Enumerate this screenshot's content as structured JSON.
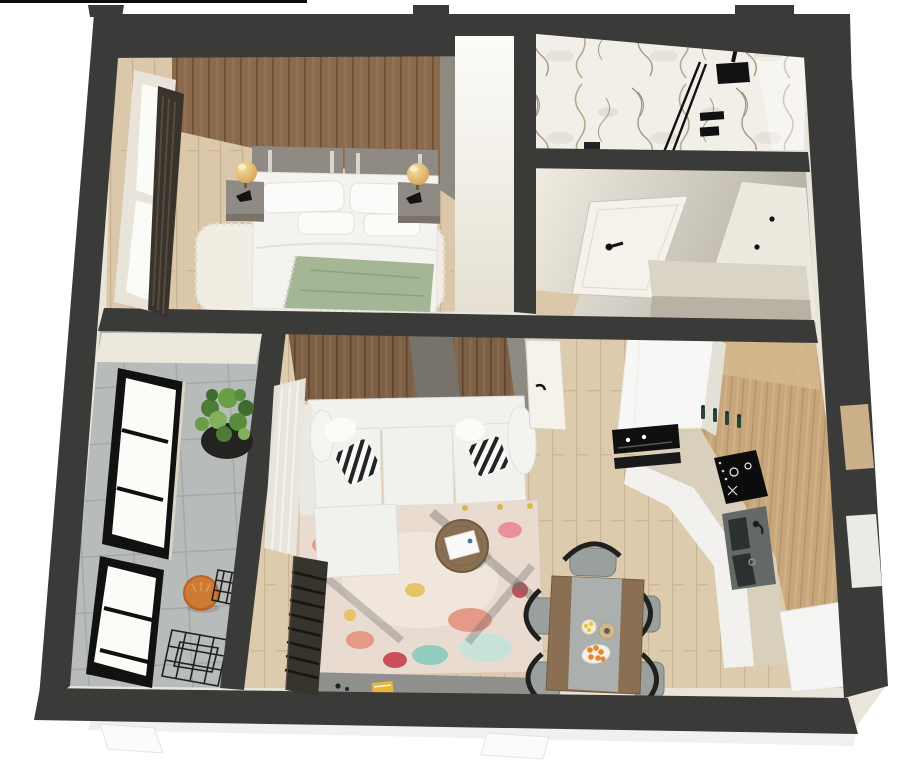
{
  "meta": {
    "type": "3d-floorplan-render",
    "style": "isometric cutaway, top-down perspective",
    "background": "#ffffff"
  },
  "palette": {
    "wall": "#3a3a38",
    "creamBase": "#e9e5da",
    "slab": "#f0f1ef",
    "floorWood": "#dbc8ab",
    "floorLiving": "#ddcbae",
    "tile": "#b7bcba",
    "marble": "#f2efe9",
    "accentBedWood": "#8a6a4c",
    "accentLivingWood": "#7c5f45",
    "kitchenWood": "#c8a67c",
    "counterBeige": "#d8d0bc",
    "whiteUnit": "#f7f7f5",
    "sofaWhite": "#f1f1ee",
    "bedWhite": "#f4f3f0",
    "headboard": "#8f8a83",
    "sage": "#a4b694",
    "lampGold": "#e9c06a",
    "rugBase": "#eadbd1",
    "rugCoral": "#e59a88",
    "rugRed": "#c9505a",
    "rugTeal": "#93cdbf",
    "rugYellow": "#e4c468",
    "stool": "#cf7a33",
    "plant": "#5d8f41",
    "plantDark": "#232320",
    "seatGray": "#9aa09e",
    "runner": "#abb0ae",
    "tableWood": "#8b6f53",
    "doorWhite": "#f5f2eb",
    "hallLight": "#f0ece2",
    "hallShade": "#b5afa3",
    "taupe": "#8e8981",
    "grayInset": "#77726b",
    "curtain": "#3a332c",
    "slatPanel": "#37332d",
    "ovenBlack": "#101010",
    "sinkGray": "#636967",
    "sinkBasin": "#2c312f",
    "bottle": "#274538",
    "peninsula": "#f5f5f3",
    "grayBand": "#8f908c",
    "book": "#e5b53e",
    "orange": "#e2892f",
    "wireChair": "#20201e",
    "frameBlack": "#111111",
    "glassWhite": "#fbfbf8",
    "shagRug": "#f1ede3",
    "windowFrameCream": "#e9e4da"
  },
  "rooms": [
    {
      "id": "bedroom",
      "label": "bedroom",
      "furniture": [
        "wood-accent-wall",
        "double-bed",
        "headboard",
        "pillows",
        "sage-throw-blanket",
        "shag-rug",
        "nightstand-left",
        "nightstand-right",
        "gold-table-lamps",
        "window-with-dark-curtains"
      ]
    },
    {
      "id": "bathroom",
      "label": "bathroom",
      "furniture": [
        "marble-feature-wall",
        "walk-in-shower",
        "black-shower-head",
        "glass-screen",
        "shower-controls",
        "floor-drain"
      ]
    },
    {
      "id": "hallway",
      "label": "hallway",
      "furniture": [
        "open-white-door",
        "built-in-wardrobe",
        "low-gray-cabinet"
      ]
    },
    {
      "id": "living-room",
      "label": "living room",
      "furniture": [
        "white-sectional-sofa",
        "striped-pillows",
        "round-coffee-table",
        "multicolor-rug",
        "sheer-curtain",
        "dark-slat-panel",
        "yellow-book"
      ]
    },
    {
      "id": "kitchen",
      "label": "kitchen",
      "furniture": [
        "tall-white-cabinet",
        "built-in-oven",
        "wood-l-counter",
        "induction-hob",
        "double-sink",
        "green-bottles",
        "white-peninsula"
      ]
    },
    {
      "id": "dining-area",
      "label": "dining area",
      "furniture": [
        "wood-dining-table",
        "gray-table-runner",
        "black-wishbone-chairs",
        "plates-with-oranges-and-lemons"
      ]
    },
    {
      "id": "balcony",
      "label": "balcony",
      "furniture": [
        "tile-floor",
        "potted-plant",
        "orange-drum-stool",
        "black-wire-chairs",
        "framed-windows"
      ]
    }
  ]
}
